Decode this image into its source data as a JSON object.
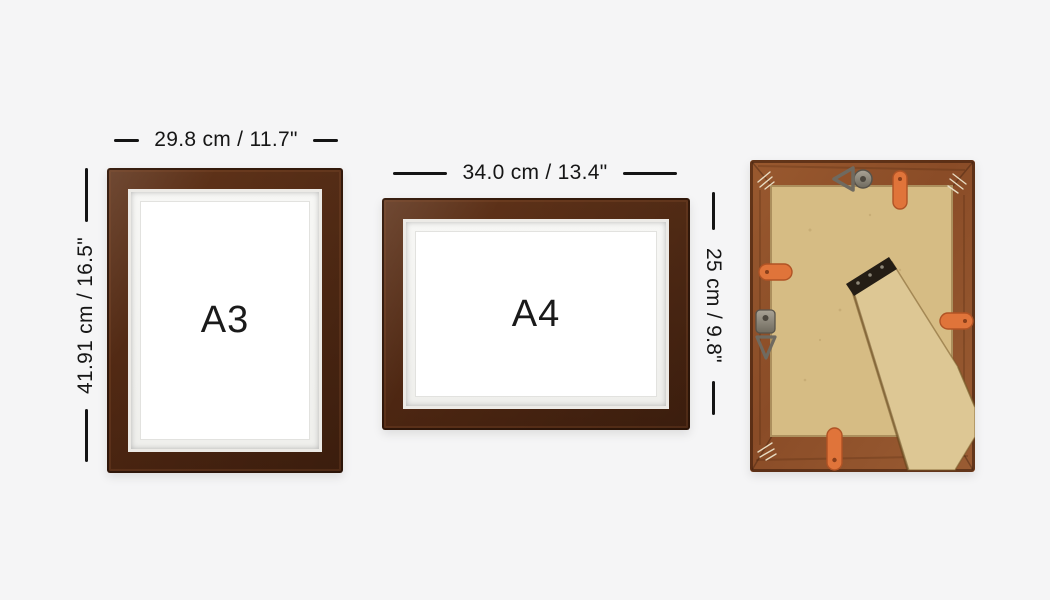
{
  "scene": {
    "background": "#f5f5f6",
    "annotation_color": "#161616",
    "description_visible_text_only": true
  },
  "frames": [
    {
      "id": "a3",
      "size_label": "A3",
      "width_dimension": "29.8 cm / 11.7\"",
      "height_dimension": "41.91 cm / 16.5\"",
      "orientation": "portrait"
    },
    {
      "id": "a4",
      "size_label": "A4",
      "width_dimension": "34.0 cm / 13.4\"",
      "height_dimension": "25 cm / 9.8\"",
      "orientation": "landscape"
    }
  ],
  "back_view": {
    "parts": [
      "wood-frame",
      "backing-board",
      "easel-stand-leg",
      "easel-hinge",
      "flexi-clip-top-right",
      "flexi-clip-left",
      "flexi-clip-right",
      "flexi-clip-bottom",
      "triangle-hanger-top",
      "swivel-hanger-left",
      "corner-joint-marks"
    ]
  },
  "colors": {
    "front_frame_wood": "#5d3118",
    "back_frame_wood": "#8f5230",
    "backing_board": "#d6bc84",
    "easel_leg": "#ddc794",
    "clip_orange": "#e0743a",
    "hinge_black": "#241d15",
    "metal_hardware": "#8d8778",
    "mat_white": "#ffffff"
  }
}
